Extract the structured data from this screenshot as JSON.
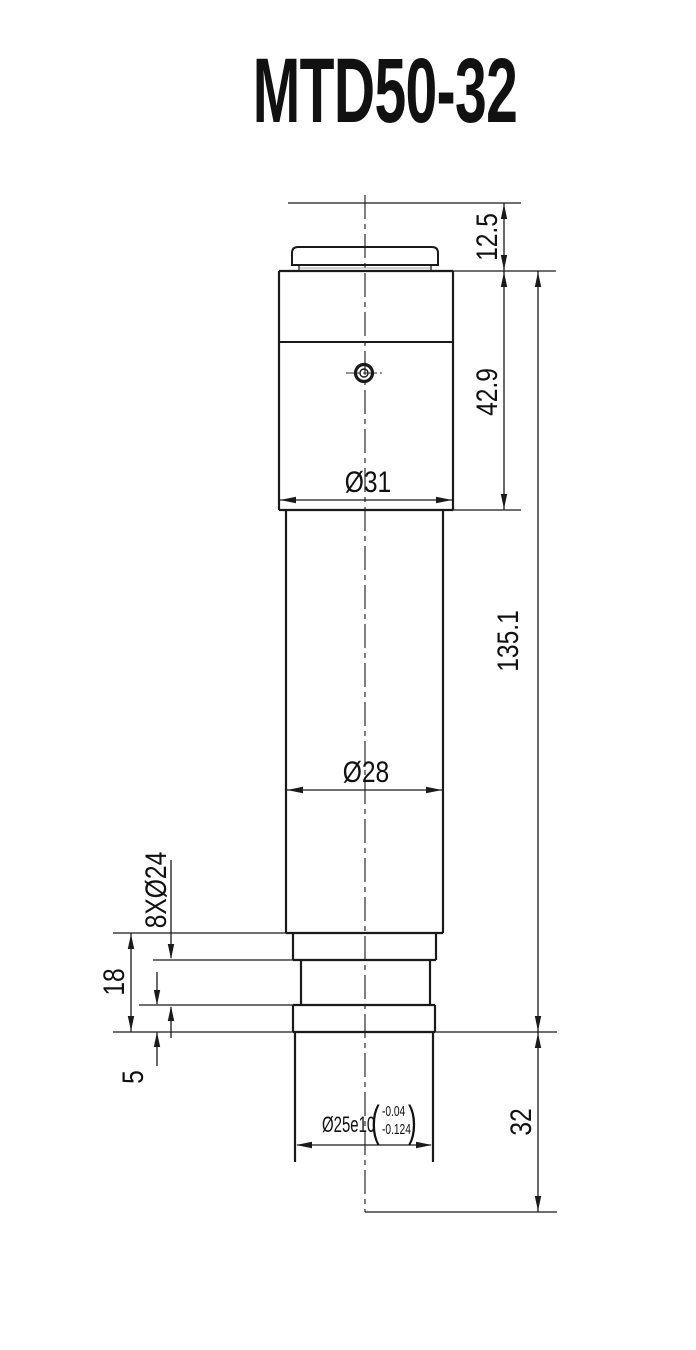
{
  "title": "MTD50-32",
  "colors": {
    "line": "#1a1a1a",
    "background": "#ffffff"
  },
  "dimensions": {
    "cap_height": "12.5",
    "upper_body_height": "42.9",
    "upper_body_diameter": "Ø31",
    "body_length": "135.1",
    "tube_diameter": "Ø28",
    "flange_holes": "8XØ24",
    "flange_height": "18",
    "flange_step_height": "5",
    "shaft_length": "32",
    "shaft_diameter": "Ø25e10",
    "shaft_tolerance_upper": "-0.04",
    "shaft_tolerance_lower": "-0.124",
    "shaft_tolerance_open_paren": "(",
    "shaft_tolerance_close_paren": ")"
  }
}
